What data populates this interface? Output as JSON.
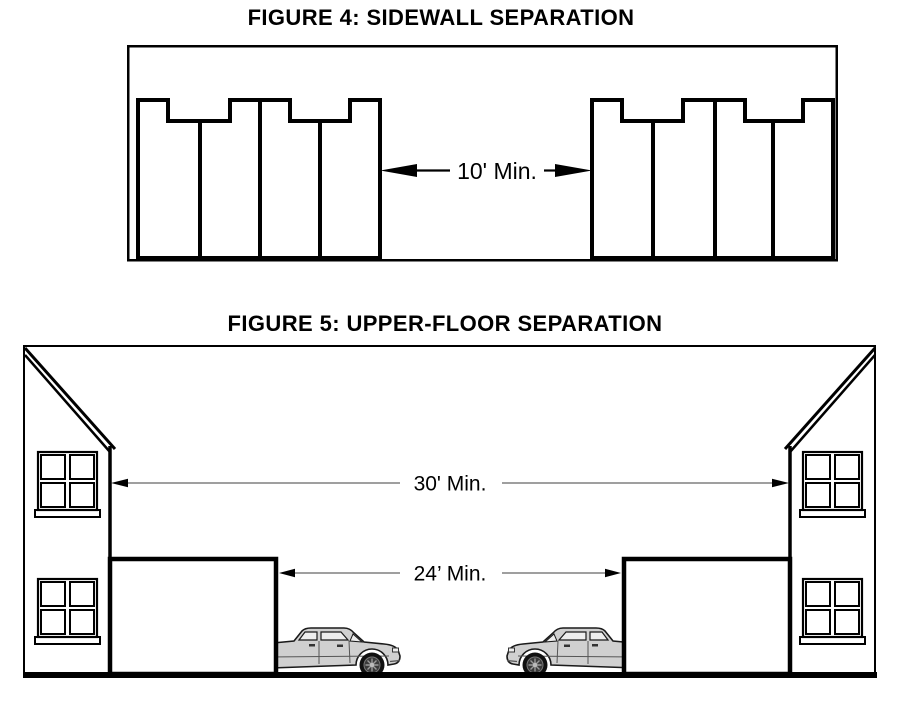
{
  "figure4": {
    "title": "FIGURE 4: SIDEWALL SEPARATION",
    "dimension_label": "10' Min."
  },
  "figure5": {
    "title": "FIGURE 5: UPPER-FLOOR SEPARATION",
    "upper_dimension_label": "30' Min.",
    "lower_dimension_label": "24’ Min."
  },
  "colors": {
    "ink": "#000000",
    "background": "#ffffff",
    "dimension_line": "#666666",
    "car_body": "#d0d0d0"
  }
}
